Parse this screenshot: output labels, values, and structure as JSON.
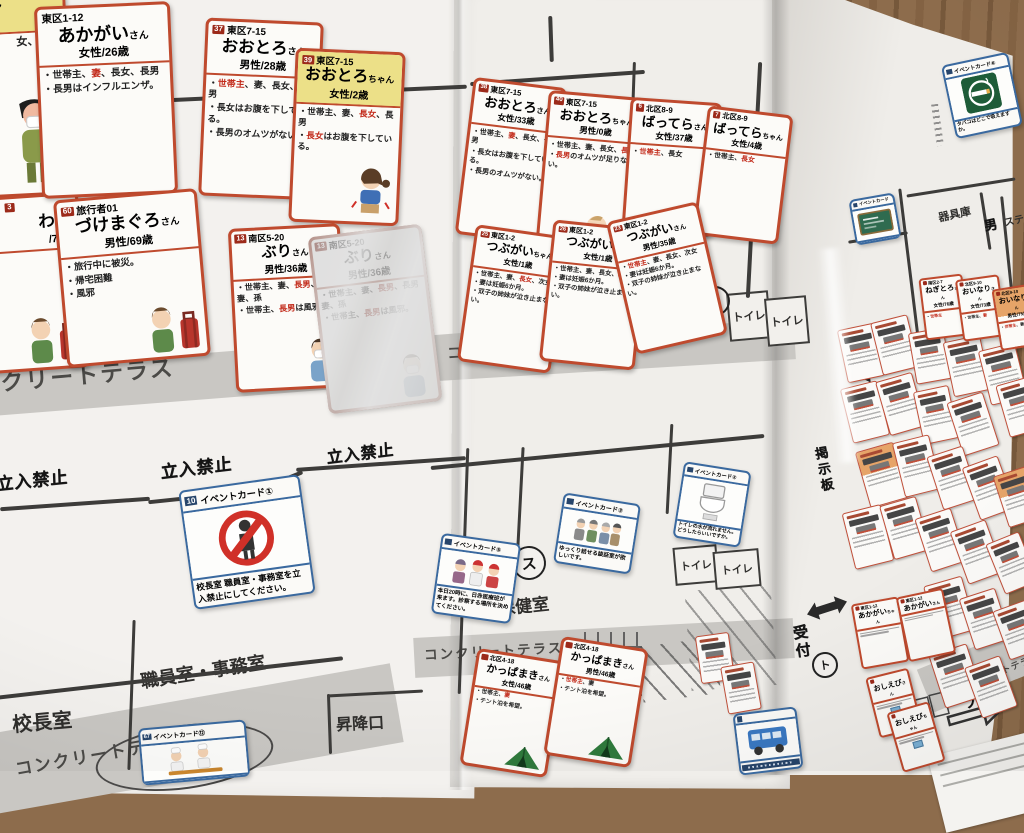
{
  "labels": {
    "no_entry": "立入禁止",
    "terrace": "コンクリートテラス",
    "terrace_partial": "クリートテラス",
    "terrace_partial2": "コンクリートテラ",
    "principal": "校長室",
    "staff_office": "職員室・事務室",
    "entrance": "昇降口",
    "health_room": "保健室",
    "toilet": "トイレ",
    "equipment": "器具庫",
    "stage_partial": "ステ",
    "male": "男",
    "reception": "受付",
    "bulletin_board": "掲示板",
    "pool": "プール",
    "mark_su": "ス",
    "mark_to": "ト"
  },
  "partials": {
    "p_child": {
      "suffix": "ちゃん",
      "meta": "歳",
      "frag": "女、",
      "frag_red": "長男"
    },
    "p_trav": {
      "num": "3",
      "name_frag": "わ",
      "suffix": "さん",
      "meta": "/73歳",
      "frag1": "妻",
      "frag2": "に被災。",
      "frag3": "難"
    }
  },
  "family_cards": [
    {
      "id": "akagai",
      "badge": false,
      "addr": "東区1-12",
      "name": "あかがい",
      "suffix": "さん",
      "meta": "女性/26歳",
      "bullets": [
        "世帯主、妻、長女、長男",
        "長男はインフルエンザ。"
      ],
      "red": [
        "妻"
      ]
    },
    {
      "id": "c37",
      "num": "37",
      "addr": "東区7-15",
      "name": "おおとろ",
      "suffix": "さん",
      "meta": "男性/28歳",
      "bullets": [
        "世帯主、妻、長女、長男",
        "長女はお腹を下している。",
        "長男のオムツがない。"
      ],
      "red": [
        "世帯主"
      ]
    },
    {
      "id": "c39",
      "num": "39",
      "addr": "東区7-15",
      "name": "おおとろ",
      "suffix": "ちゃん",
      "meta": "女性/2歳",
      "child": true,
      "bullets": [
        "世帯主、妻、長女、長男",
        "長女はお腹を下している。"
      ],
      "red": [
        "長女"
      ],
      "illus": "girl"
    },
    {
      "id": "c60",
      "num": "60",
      "addr": "旅行者01",
      "name": "づけまぐろ",
      "suffix": "さん",
      "meta": "男性/69歳",
      "bullets": [
        "旅行中に被災。",
        "帰宅困難",
        "風邪"
      ],
      "red": [],
      "illus": "man_suitcase"
    },
    {
      "id": "c13",
      "num": "13",
      "addr": "南区5-20",
      "name": "ぶり",
      "suffix": "さん",
      "meta": "男性/36歳",
      "bullets": [
        "世帯主、妻、長男、長男妻、孫",
        "世帯主、長男は風邪。"
      ],
      "red": [
        "長男"
      ],
      "illus": "man_mask"
    },
    {
      "id": "c13g",
      "num": "13",
      "addr": "南区5-20",
      "name": "ぶり",
      "suffix": "さん",
      "meta": "男性/36歳",
      "glare": true,
      "bullets": [
        "世帯主、妻、長男、長男妻、孫",
        "世帯主、長男は風邪。"
      ],
      "red": [
        "長男"
      ],
      "illus": "man_mask"
    },
    {
      "id": "c38",
      "num": "38",
      "addr": "東区7-15",
      "name": "おおとろ",
      "suffix": "さん",
      "meta": "女性/33歳",
      "bullets": [
        "世帯主、妻、長女、長男",
        "長女はお腹を下している。",
        "長男のオムツがない。"
      ],
      "red": [
        "妻"
      ]
    },
    {
      "id": "c40",
      "num": "40",
      "addr": "東区7-15",
      "name": "おおとろ",
      "suffix": "ちゃん",
      "meta": "男性/0歳",
      "bullets": [
        "世帯主、妻、長女、長男",
        "長男のオムツが足りない。"
      ],
      "red": [
        "長男"
      ],
      "illus": "baby"
    },
    {
      "id": "c6",
      "num": "6",
      "addr": "北区8-9",
      "name": "ばってら",
      "suffix": "さん",
      "meta": "女性/37歳",
      "bullets": [
        "世帯主、長女"
      ],
      "red": [
        "世帯主"
      ]
    },
    {
      "id": "c7",
      "num": "7",
      "addr": "北区8-9",
      "name": "ばってら",
      "suffix": "ちゃん",
      "meta": "女性/4歳",
      "bullets": [
        "世帯主、長女"
      ],
      "red": [
        "長女"
      ]
    },
    {
      "id": "c25",
      "num": "25",
      "addr": "東区1-2",
      "name": "つぶがい",
      "suffix": "ちゃん",
      "meta": "女性/1歳",
      "bullets": [
        "世帯主、妻、長女、次女",
        "妻は妊娠6か月。",
        "双子の姉妹が泣き止まない。"
      ],
      "red": [
        "長女"
      ]
    },
    {
      "id": "c26",
      "num": "26",
      "addr": "東区1-2",
      "name": "つぶがい",
      "suffix": "ちゃん",
      "meta": "女性/1歳",
      "bullets": [
        "世帯主、妻、長女、次女",
        "妻は妊娠6か月。",
        "双子の姉妹が泣き止まない。"
      ],
      "red": [
        "次女"
      ]
    },
    {
      "id": "c23",
      "num": "23",
      "addr": "東区1-2",
      "name": "つぶがい",
      "suffix": "さん",
      "meta": "男性/35歳",
      "bullets": [
        "世帯主、妻、長女、次女",
        "妻は妊娠6か月。",
        "双子の姉妹が泣き止まない。"
      ],
      "red": [
        "世帯主"
      ]
    },
    {
      "id": "kappa1",
      "num": "",
      "addr": "北区4-18",
      "name": "かっぱまき",
      "suffix": "さん",
      "meta": "女性/46歳",
      "bullets": [
        "世帯主、妻",
        "テント泊を希望。"
      ],
      "red": [
        "妻"
      ],
      "illus": "tent"
    },
    {
      "id": "kappa2",
      "num": "",
      "addr": "北区4-18",
      "name": "かっぱまき",
      "suffix": "さん",
      "meta": "男性/46歳",
      "bullets": [
        "世帯主、妻",
        "テント泊を希望。"
      ],
      "red": [
        "世帯主"
      ],
      "illus": "tent"
    }
  ],
  "tiny_cards": [
    {
      "id": "negitoro",
      "num": "",
      "addr": "南区2-7",
      "name": "ねぎとろ",
      "suffix": "さん",
      "meta": "女性/76歳",
      "bullets": [
        "世帯主"
      ],
      "red": [
        "世帯主"
      ]
    },
    {
      "id": "oinari1",
      "num": "",
      "addr": "北区9-10",
      "name": "おいなり",
      "suffix": "さん",
      "meta": "女性/73歳",
      "bullets": [
        "世帯主、妻"
      ],
      "red": [
        "妻"
      ]
    },
    {
      "id": "oinari2",
      "num": "",
      "addr": "北区9-10",
      "name": "おいなり",
      "suffix": "さん",
      "meta": "男性/75歳",
      "orange": true,
      "bullets": [
        "世帯主、妻"
      ],
      "red": [
        "世帯主"
      ]
    },
    {
      "id": "akagai_c1",
      "num": "",
      "addr": "東区1-12",
      "name": "あかがい",
      "suffix": "ちゃん",
      "meta": "",
      "bullets": [],
      "red": []
    },
    {
      "id": "akagai_c2",
      "num": "",
      "addr": "東区1-12",
      "name": "あかがい",
      "suffix": "さん",
      "meta": "",
      "bullets": [],
      "red": []
    },
    {
      "id": "oshiebi1",
      "num": "",
      "addr": "",
      "name": "おしえび",
      "suffix": "さん",
      "meta": "",
      "bullets": [],
      "red": [],
      "pic": "blue"
    },
    {
      "id": "oshiebi2",
      "num": "",
      "addr": "",
      "name": "おしえび",
      "suffix": "ちゃん",
      "meta": "",
      "bullets": [],
      "red": [],
      "pic": "blue"
    }
  ],
  "event_cards": [
    {
      "id": "e10",
      "num": "10",
      "title": "イベントカード①",
      "icon": "noentry",
      "text": "校長室 職員室・事務室を立入禁止にしてください。"
    },
    {
      "id": "e5",
      "num": "",
      "title": "イベントカード⑤",
      "icon": "medics",
      "text": "本日20時に、日赤医療班が来ます。診察する場所を決めてください。"
    },
    {
      "id": "e3",
      "num": "",
      "title": "イベントカード③",
      "icon": "elderly",
      "text": "ゆっくり話せる談話室が欲しいです。"
    },
    {
      "id": "e2",
      "num": "",
      "title": "イベントカード②",
      "icon": "toilet",
      "text": "トイレの水が流れません。どうしたらいいですか。"
    },
    {
      "id": "e6",
      "num": "",
      "title": "イベントカード⑥",
      "icon": "smoke",
      "text": "タバコはどこで吸えますか。"
    },
    {
      "id": "e67",
      "num": "67",
      "title": "イベントカード⑫",
      "icon": "cooks",
      "text": ""
    },
    {
      "id": "eboard",
      "num": "",
      "title": "イベントカード",
      "icon": "board",
      "text": ""
    },
    {
      "id": "ebus",
      "num": "",
      "title": "",
      "icon": "bus",
      "text": "",
      "strip": true
    }
  ],
  "icons": {
    "noentry": "red prohibition circle over person pictogram",
    "medics": "red-cross medical team figures",
    "elderly": "group of elderly residents",
    "toilet": "toilet bowl",
    "smoke": "green smoking-area sign with cigarette",
    "cooks": "cooking volunteers with tray",
    "board": "green blackboard",
    "bus": "blue bus",
    "girl": "girl with stomachache",
    "baby": "crawling baby with bottle",
    "man_suitcase": "traveler with red suitcase",
    "man_mask": "man wearing mask",
    "boy_mask": "boy wearing mask",
    "tent": "green tent"
  }
}
